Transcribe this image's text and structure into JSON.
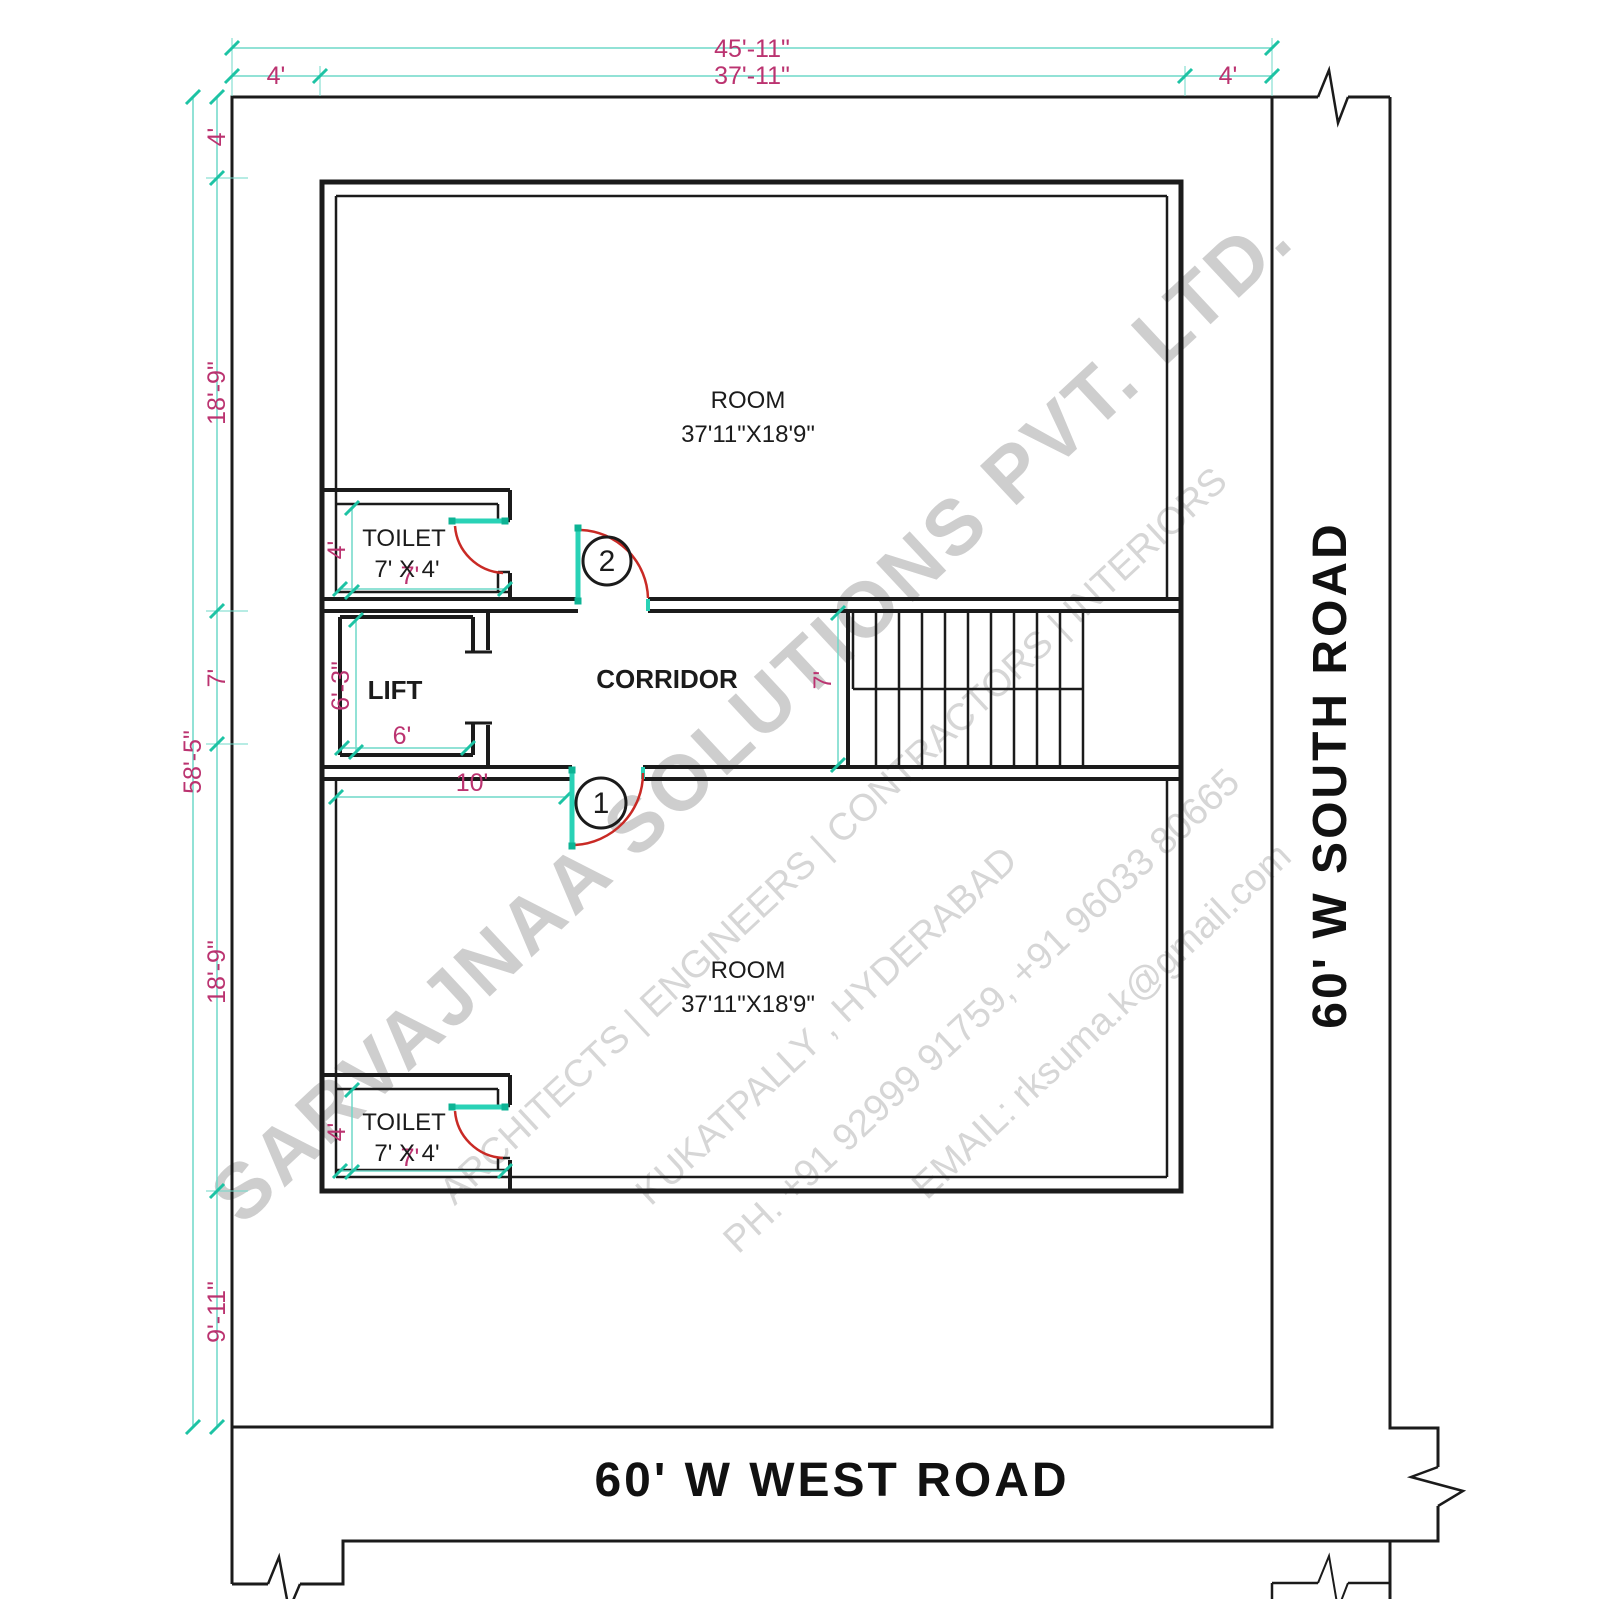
{
  "roads": {
    "south": "60' W SOUTH ROAD",
    "west": "60' W WEST ROAD"
  },
  "rooms": {
    "room_top": {
      "label": "ROOM",
      "size": "37'11\"X18'9\""
    },
    "room_bottom": {
      "label": "ROOM",
      "size": "37'11\"X18'9\""
    },
    "toilet_top": {
      "label": "TOILET",
      "size": "7' X 4'"
    },
    "toilet_bottom": {
      "label": "TOILET",
      "size": "7' X 4'"
    },
    "lift": {
      "label": "LIFT"
    },
    "corridor": {
      "label": "CORRIDOR"
    }
  },
  "doors": {
    "door1_tag": "1",
    "door2_tag": "2"
  },
  "dimensions": {
    "plot_width": "45'-11\"",
    "building_width": "37'-11\"",
    "setback_top_left": "4'",
    "setback_top_right": "4'",
    "setback_left_top": "4'",
    "plot_depth": "58'-5\"",
    "room_top_depth": "18'-9\"",
    "corridor_depth": "7'",
    "room_bottom_depth": "18'-9\"",
    "setback_bottom": "9'-11\"",
    "toilet_top_depth": "4'",
    "toilet_top_width": "7'",
    "lift_depth": "6'-3\"",
    "lift_width": "6'",
    "stair_depth": "7'",
    "door1_offset": "10'",
    "toilet_bottom_depth": "4'",
    "toilet_bottom_width": "7'"
  },
  "watermark": {
    "company": "SARVAJNAA SOLUTIONS PVT. LTD.",
    "services": "ARCHITECTS | ENGINEERS | CONTRACTORS | INTERIORS",
    "location": "KUKATPALLY , HYDERABAD",
    "phone": "PH. +91 92999 91759, +91 96033 80665",
    "email": "EMAIL: rksuma.k@gmail.com"
  },
  "colors": {
    "wall": "#1b1b1b",
    "dimension_line": "#6fd9c9",
    "dimension_tick": "#1dc3a4",
    "dimension_text": "#bb3370",
    "door_leaf": "#29d2b6",
    "door_swing": "#c92a25",
    "watermark": "#d2d2d2"
  }
}
